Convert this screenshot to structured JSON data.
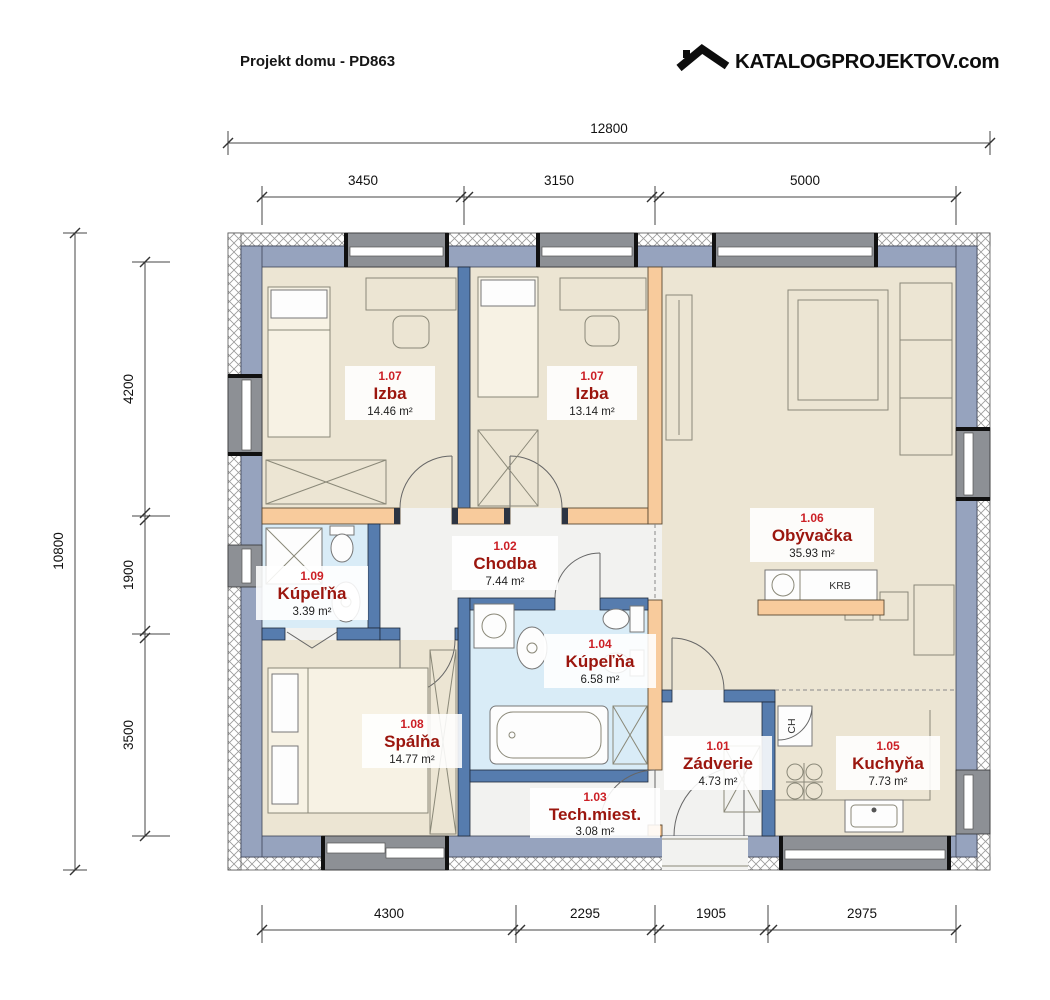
{
  "header": {
    "title": "Projekt domu - PD863",
    "brand": "KATALOGPROJEKTOV.com"
  },
  "dimensions": {
    "top_total": "12800",
    "top_segments": [
      "3450",
      "3150",
      "5000"
    ],
    "left_total": "10800",
    "left_segments": [
      "4200",
      "1900",
      "3500"
    ],
    "bottom_segments": [
      "4300",
      "2295",
      "1905",
      "2975"
    ]
  },
  "rooms": {
    "zadverie": {
      "number": "1.01",
      "name": "Zádverie",
      "area": "4.73 m²"
    },
    "chodba": {
      "number": "1.02",
      "name": "Chodba",
      "area": "7.44 m²"
    },
    "tech": {
      "number": "1.03",
      "name": "Tech.miest.",
      "area": "3.08 m²"
    },
    "kupelna104": {
      "number": "1.04",
      "name": "Kúpeľňa",
      "area": "6.58 m²"
    },
    "kuchyna": {
      "number": "1.05",
      "name": "Kuchyňa",
      "area": "7.73 m²"
    },
    "obyvacka": {
      "number": "1.06",
      "name": "Obývačka",
      "area": "35.93 m²"
    },
    "izba1": {
      "number": "1.07",
      "name": "Izba",
      "area": "14.46 m²"
    },
    "izba2": {
      "number": "1.07",
      "name": "Izba",
      "area": "13.14 m²"
    },
    "spalna": {
      "number": "1.08",
      "name": "Spálňa",
      "area": "14.77 m²"
    },
    "kupelna109": {
      "number": "1.09",
      "name": "Kúpeľňa",
      "area": "3.39 m²"
    }
  },
  "annotations": {
    "fireplace": "KRB",
    "fridge": "CH"
  },
  "colors": {
    "exterior_wall": "#96a3be",
    "partition_wall": "#567cae",
    "timber_wall": "#f8cb9c",
    "floor_room": "#ece5d3",
    "floor_bath": "#d9ecf7",
    "floor_hall": "#f2f2f0",
    "room_number": "#cc2026",
    "room_name": "#9b160e"
  }
}
